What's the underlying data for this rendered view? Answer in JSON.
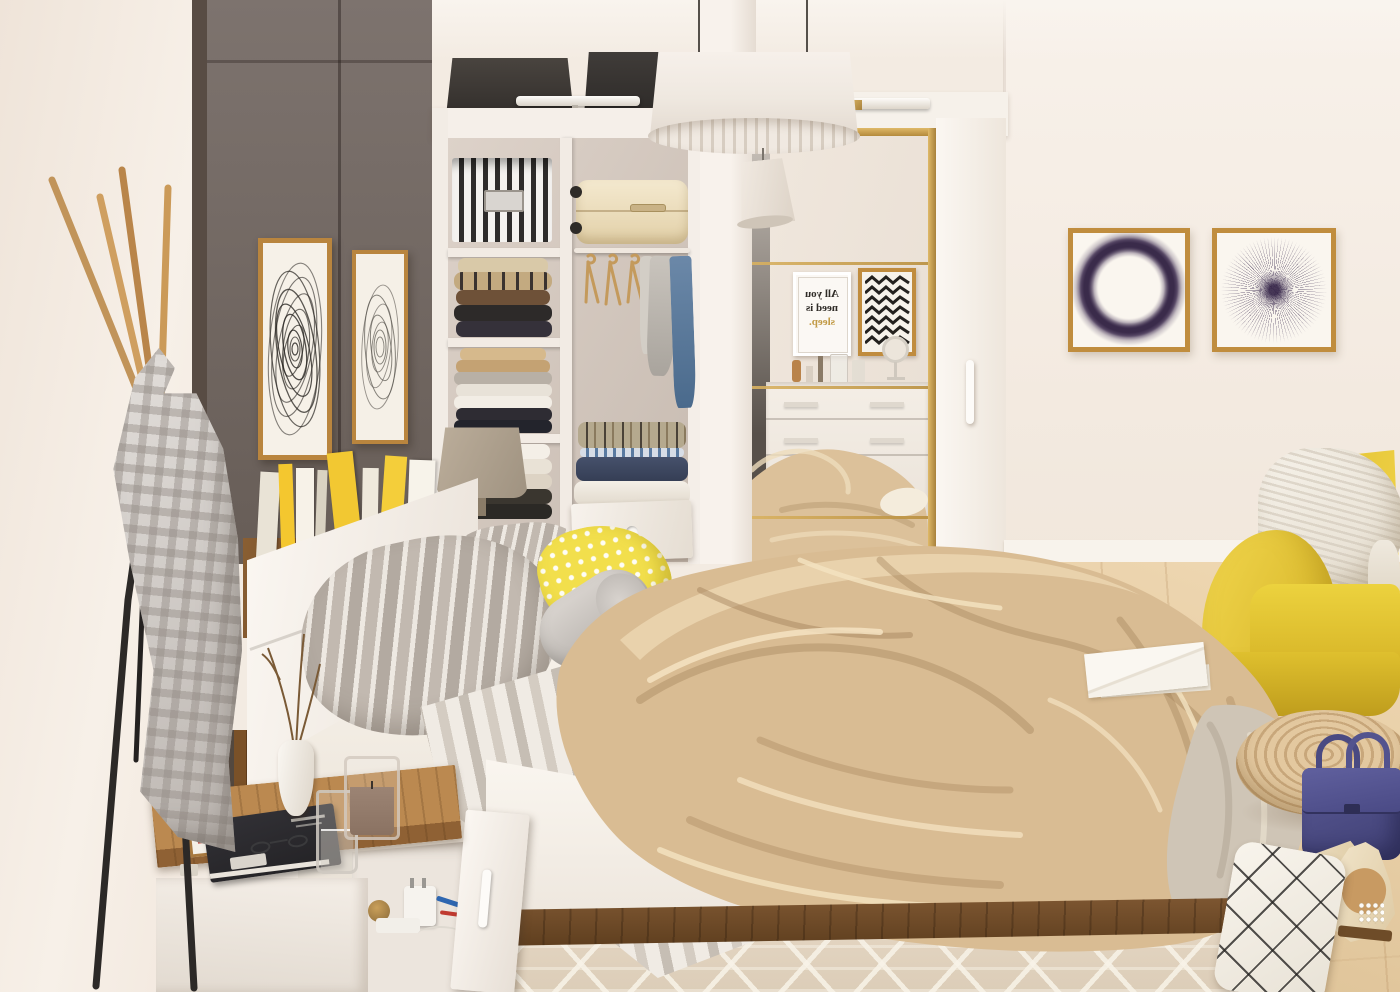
{
  "scene": {
    "description": "Sunlit scandinavian bedroom render: white storage bed, open wardrobe with mirrored sliding door, coat stand with gingham robe, yellow armchair",
    "mirror_poster": {
      "line1": "All you",
      "line2": "need is",
      "line3": "sleep.",
      "mirrored": true,
      "accent_word_color": "#c19a45"
    }
  },
  "palette": {
    "wall_warm_white": "#f3ebe2",
    "dark_wardrobe_panel": "#6f6560",
    "gold_trim": "#c59a4e",
    "closet_white": "#f4eee7",
    "wood_nightstand_top": "#b0814b",
    "walnut_plinth": "#6f4c2a",
    "floor_wood": "#e7cfa7",
    "blanket_beige": "#d9bc93",
    "pillow_stripe_gray": "#b5aca3",
    "pillow_yellow": "#f2df4c",
    "armchair_yellow": "#e7c934",
    "handbag_navy": "#4b4b86",
    "artwork_purple": "#3c2b4e",
    "robe_gingham_gray": "#cdc7c2",
    "rug_beige": "#e4d6c3"
  },
  "objects": [
    "large drum pendant lamp",
    "small pendant lamp",
    "dark gray wall panels",
    "two framed scribble artworks",
    "white open wardrobe",
    "fabric storage boxes",
    "striped storage box",
    "cream suitcase",
    "wooden hangers",
    "hanging shirts",
    "folded clothes stacks",
    "pull-out wardrobe drawer",
    "beige table lamp",
    "mirrored sliding door with gold trim",
    "reflected sleep poster",
    "reflected chevron artwork",
    "reflected dresser with cosmetics",
    "round vanity mirror",
    "white sliding door with handle",
    "gold framed circle artwork",
    "gold framed starburst artwork",
    "coat stand",
    "gray gingham robe",
    "headboard shelf with books and magazines",
    "white bed",
    "gray striped pillows",
    "yellow polka-dot pillow",
    "gray bolster pillow",
    "beige throw blanket",
    "white envelope on bed",
    "striped runner blanket",
    "walnut bed plinth",
    "open storage drawer with charger and pens",
    "wooden top nightstand",
    "black book with sunglasses",
    "glass of water",
    "candle in glass",
    "white vase with twigs",
    "small picture frame",
    "yellow armchair",
    "white knitted throw",
    "rattan pouf",
    "navy handbag",
    "cream high heels",
    "grid pattern pillow",
    "patterned beige rug",
    "light wood floor"
  ]
}
